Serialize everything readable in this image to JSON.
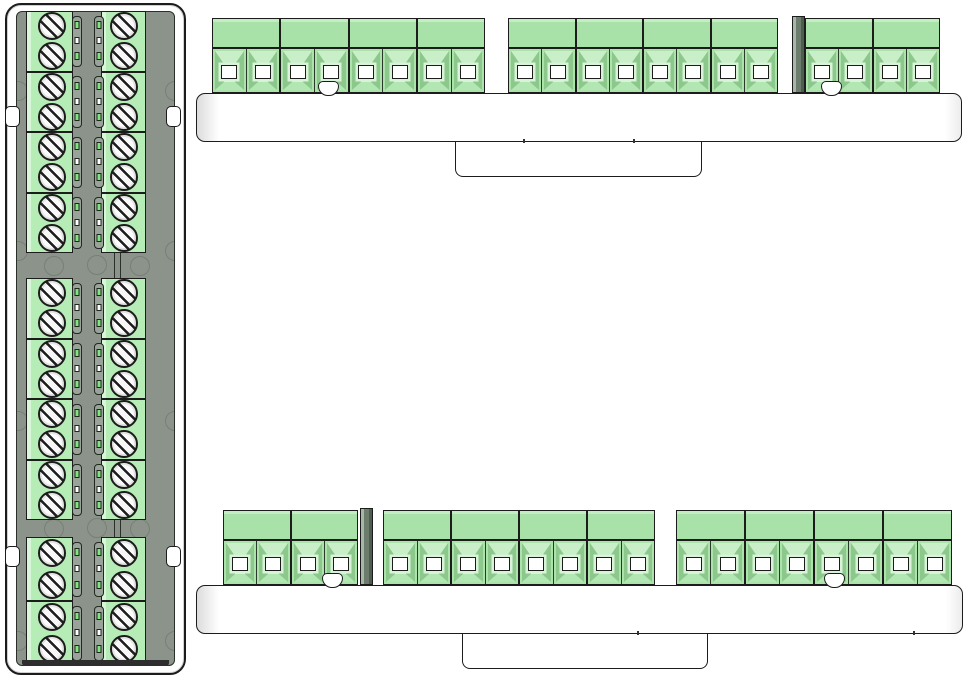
{
  "view_type": "cad-terminal-block-drawing",
  "canvas": {
    "width": 968,
    "height": 678,
    "background": "#ffffff"
  },
  "colors": {
    "outline": "#1c1c1c",
    "panel_gray": "#8b938b",
    "capsule_gray": "#99a399",
    "green_top_view": "#b6ecb6",
    "green_top_view_edge": "#daf6da",
    "band_green": "#a8e2a8",
    "band_green_light": "#c2eec2",
    "pole_face": "#abe3ab",
    "bevel_top": "#c8efc8",
    "bevel_side": "#8cc88c",
    "opening_frame": "#d8f3d8",
    "screw_fill": "#f3f3f3",
    "sliver_light": "#a7b7a7",
    "sliver_mid": "#6d7d6d",
    "sliver_dark": "#4f5d4f",
    "board_white": "#ffffff",
    "board_edge_shade": "#dcdcdc",
    "dark_band": "#2e2e2e",
    "bright_green": "#7fe57f"
  },
  "top_view_module": {
    "frame": {
      "x": 5,
      "y": 3,
      "w": 181,
      "h": 672,
      "radius": 16
    },
    "panel": {
      "x": 16,
      "y": 11,
      "w": 159,
      "h": 655
    },
    "side_clips": [
      {
        "x": 5,
        "y": 106
      },
      {
        "x": 5,
        "y": 546
      },
      {
        "x": 166,
        "y": 106
      },
      {
        "x": 166,
        "y": 546
      }
    ],
    "side_clip_size": {
      "w": 15,
      "h": 21
    },
    "columns": [
      {
        "x": 26,
        "w": 47,
        "screw_cx": 52,
        "capsule_x": 72
      },
      {
        "x": 101,
        "w": 45,
        "screw_cx": 124,
        "capsule_x": 94
      }
    ],
    "screw_diameter": 28,
    "groups": [
      {
        "y": 11,
        "block_h": 60.5,
        "blocks": 4
      },
      {
        "y": 278,
        "block_h": 60.5,
        "blocks": 4
      },
      {
        "y": 537,
        "block_h": 64,
        "blocks": 2
      }
    ],
    "gap_connectors": [
      {
        "x": 113.5,
        "y1": 253,
        "y2": 278
      },
      {
        "x": 119.5,
        "y1": 253,
        "y2": 278
      },
      {
        "x": 113.5,
        "y1": 520,
        "y2": 537
      },
      {
        "x": 119.5,
        "y1": 520,
        "y2": 537
      }
    ],
    "bottom_seal": {
      "x": 22,
      "y": 660,
      "w": 147,
      "h": 6
    },
    "ghost_circles": [
      {
        "cx": 17,
        "cy": 90
      },
      {
        "cx": 17,
        "cy": 250
      },
      {
        "cx": 17,
        "cy": 420
      },
      {
        "cx": 17,
        "cy": 640
      },
      {
        "cx": 174,
        "cy": 90
      },
      {
        "cx": 174,
        "cy": 250
      },
      {
        "cx": 174,
        "cy": 420
      },
      {
        "cx": 174,
        "cy": 640
      },
      {
        "cx": 53,
        "cy": 265
      },
      {
        "cx": 96,
        "cy": 264
      },
      {
        "cx": 139,
        "cy": 265
      },
      {
        "cx": 53,
        "cy": 528
      },
      {
        "cx": 96,
        "cy": 527
      },
      {
        "cx": 139,
        "cy": 528
      }
    ],
    "ghost_radius": 10
  },
  "front_views": [
    {
      "id": "top-board",
      "board": {
        "x": 196,
        "y": 93,
        "w": 766,
        "h": 49,
        "radius": 9
      },
      "tab": {
        "x": 455,
        "y": 140,
        "w": 247,
        "h": 37,
        "radius": 8
      },
      "band": {
        "y": 18,
        "h": 30
      },
      "poles_row": {
        "y": 48,
        "h": 45
      },
      "groups": [
        {
          "x": 212,
          "blocks": 4,
          "block_w": 68.3
        },
        {
          "x": 508,
          "blocks": 4,
          "block_w": 67.5
        },
        {
          "x": 805,
          "blocks": 2,
          "block_w": 67.5
        }
      ],
      "side_profiles": [
        {
          "x": 792,
          "y": 16,
          "w": 13,
          "h": 77
        }
      ],
      "mounting_holes": [
        {
          "cx": 328,
          "y": 81
        },
        {
          "cx": 831,
          "y": 81
        }
      ],
      "edge_marks": [
        {
          "x": 523
        },
        {
          "x": 633
        }
      ]
    },
    {
      "id": "bottom-board",
      "board": {
        "x": 196,
        "y": 585,
        "w": 767,
        "h": 49,
        "radius": 9
      },
      "tab": {
        "x": 462,
        "y": 632,
        "w": 246,
        "h": 37,
        "radius": 8
      },
      "band": {
        "y": 510,
        "h": 30
      },
      "poles_row": {
        "y": 540,
        "h": 45
      },
      "groups": [
        {
          "x": 223,
          "blocks": 2,
          "block_w": 67.5
        },
        {
          "x": 383,
          "blocks": 4,
          "block_w": 68
        },
        {
          "x": 676,
          "blocks": 4,
          "block_w": 69
        }
      ],
      "side_profiles": [
        {
          "x": 360,
          "y": 508,
          "w": 13,
          "h": 77
        }
      ],
      "mounting_holes": [
        {
          "cx": 332,
          "y": 573
        },
        {
          "cx": 834,
          "y": 573
        }
      ],
      "edge_marks": [
        {
          "x": 637
        },
        {
          "x": 913
        }
      ]
    }
  ]
}
